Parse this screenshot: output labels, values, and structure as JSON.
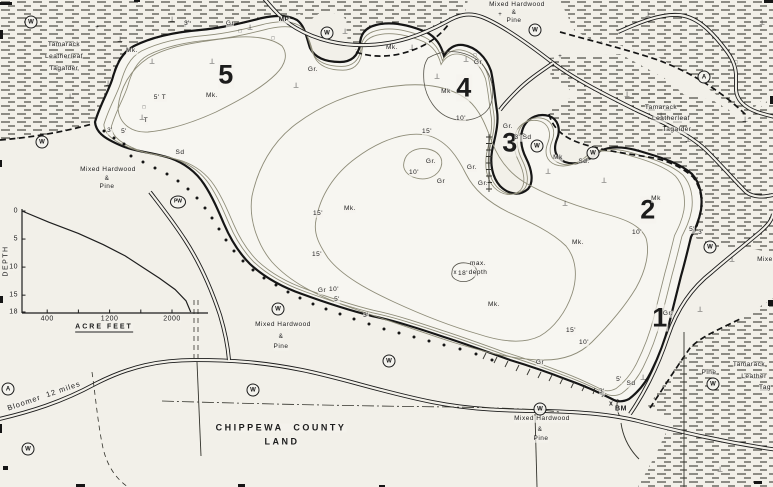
{
  "map": {
    "labels": [
      {
        "n": "veg-label-tamarack-nw-line1",
        "t": "Tamarack",
        "x": 64,
        "y": 45
      },
      {
        "n": "veg-label-tamarack-nw-line2",
        "t": "Leatherleaf",
        "x": 64,
        "y": 57
      },
      {
        "n": "veg-label-tamarack-nw-line3",
        "t": "Tagalder",
        "x": 64,
        "y": 69
      },
      {
        "n": "veg-label-mixed-hardwood-north-line1",
        "t": "Mixed Hardwood",
        "x": 517,
        "y": 5
      },
      {
        "n": "veg-label-mixed-hardwood-north-line2",
        "t": "&",
        "x": 514,
        "y": 13
      },
      {
        "n": "veg-label-mixed-hardwood-north-line3",
        "t": "Pine",
        "x": 514,
        "y": 21
      },
      {
        "n": "veg-label-tamarack-east-line1",
        "t": "Tamarack",
        "x": 661,
        "y": 108
      },
      {
        "n": "veg-label-tamarack-east-line2",
        "t": "Leatherleaf",
        "x": 671,
        "y": 119
      },
      {
        "n": "veg-label-tamarack-east-line3",
        "t": "Tagalder",
        "x": 677,
        "y": 130
      },
      {
        "n": "veg-label-mixed-hardwood-west-line1",
        "t": "Mixed Hardwood",
        "x": 108,
        "y": 170
      },
      {
        "n": "veg-label-mixed-hardwood-west-line2",
        "t": "&",
        "x": 107,
        "y": 179
      },
      {
        "n": "veg-label-mixed-hardwood-west-line3",
        "t": "Pine",
        "x": 107,
        "y": 187
      },
      {
        "n": "veg-label-mixed-hardwood-south-line1",
        "t": "Mixed Hardwood",
        "x": 283,
        "y": 325
      },
      {
        "n": "veg-label-mixed-hardwood-south-line2",
        "t": "&",
        "x": 281,
        "y": 337
      },
      {
        "n": "veg-label-mixed-hardwood-south-line3",
        "t": "Pine",
        "x": 281,
        "y": 347
      },
      {
        "n": "veg-label-mixed-hardwood-southeast-line1",
        "t": "Mixed Hardwood",
        "x": 542,
        "y": 419
      },
      {
        "n": "veg-label-mixed-hardwood-southeast-line2",
        "t": "&",
        "x": 540,
        "y": 430
      },
      {
        "n": "veg-label-mixed-hardwood-southeast-line3",
        "t": "Pine",
        "x": 541,
        "y": 439
      },
      {
        "n": "veg-label-pine-southeast",
        "t": "Pine",
        "x": 709,
        "y": 373
      },
      {
        "n": "veg-label-tamarack-se-line1",
        "t": "Tamarack",
        "x": 749,
        "y": 365
      },
      {
        "n": "veg-label-tamarack-se-line2",
        "t": "Leather",
        "x": 754,
        "y": 377
      },
      {
        "n": "veg-label-tamarack-se-line3",
        "t": "Tag",
        "x": 765,
        "y": 388
      },
      {
        "n": "veg-label-mixed-east-partial",
        "t": "Mixed",
        "x": 767,
        "y": 260
      },
      {
        "n": "county-land-label-line1",
        "t": "CHIPPEWA  COUNTY",
        "x": 281,
        "y": 428,
        "fs": 9,
        "fw": 700,
        "ls": 2.5
      },
      {
        "n": "county-land-label-line2",
        "t": "LAND",
        "x": 282,
        "y": 442,
        "fs": 9,
        "fw": 700,
        "ls": 2.5
      },
      {
        "n": "road-label-bloomer",
        "t": "Bloomer  12 miles",
        "x": 44,
        "y": 396,
        "fs": 7.5,
        "r": -19,
        "ls": 1
      },
      {
        "n": "site-number-5",
        "t": "5",
        "x": 226,
        "y": 75,
        "fs": 27,
        "fw": 800
      },
      {
        "n": "site-number-4",
        "t": "4",
        "x": 464,
        "y": 88,
        "fs": 27,
        "fw": 800
      },
      {
        "n": "site-number-3",
        "t": "3",
        "x": 510,
        "y": 143,
        "fs": 27,
        "fw": 800
      },
      {
        "n": "site-number-2",
        "t": "2",
        "x": 648,
        "y": 210,
        "fs": 27,
        "fw": 800
      },
      {
        "n": "site-number-1",
        "t": "1",
        "x": 660,
        "y": 318,
        "fs": 27,
        "fw": 800
      },
      {
        "n": "marker-mp",
        "t": "MP",
        "x": 284,
        "y": 20,
        "fw": 700
      },
      {
        "n": "marker-bm",
        "t": "BM",
        "x": 621,
        "y": 409,
        "fs": 7,
        "fw": 700
      },
      {
        "n": "substrate-label",
        "t": "Mk.",
        "x": 132,
        "y": 51
      },
      {
        "n": "substrate-label",
        "t": "Mk.",
        "x": 212,
        "y": 96
      },
      {
        "n": "depth-label",
        "t": "5' T",
        "x": 160,
        "y": 98
      },
      {
        "n": "substrate-label",
        "t": "T",
        "x": 146,
        "y": 121
      },
      {
        "n": "depth-label",
        "t": "3'",
        "x": 110,
        "y": 131
      },
      {
        "n": "depth-label",
        "t": "5'",
        "x": 124,
        "y": 132
      },
      {
        "n": "substrate-label",
        "t": "Sd",
        "x": 180,
        "y": 153
      },
      {
        "n": "depth-label",
        "t": "3'",
        "x": 187,
        "y": 24
      },
      {
        "n": "substrate-label",
        "t": "Gr",
        "x": 230,
        "y": 24
      },
      {
        "n": "substrate-label",
        "t": "Gr.",
        "x": 313,
        "y": 70
      },
      {
        "n": "substrate-label",
        "t": "Mk.",
        "x": 392,
        "y": 48
      },
      {
        "n": "substrate-label",
        "t": "Gr",
        "x": 478,
        "y": 63
      },
      {
        "n": "substrate-label",
        "t": "Mk",
        "x": 446,
        "y": 92
      },
      {
        "n": "depth-label",
        "t": "10'",
        "x": 461,
        "y": 119
      },
      {
        "n": "depth-label",
        "t": "15'",
        "x": 427,
        "y": 132
      },
      {
        "n": "substrate-label",
        "t": "Gr.",
        "x": 431,
        "y": 162
      },
      {
        "n": "depth-label",
        "t": "10'",
        "x": 414,
        "y": 173
      },
      {
        "n": "substrate-label",
        "t": "Gr",
        "x": 441,
        "y": 182
      },
      {
        "n": "substrate-label",
        "t": "Gr.",
        "x": 508,
        "y": 127
      },
      {
        "n": "depth-label",
        "t": "3' Sd",
        "x": 523,
        "y": 138
      },
      {
        "n": "substrate-label",
        "t": "Mk",
        "x": 558,
        "y": 158
      },
      {
        "n": "substrate-label",
        "t": "Sd.",
        "x": 584,
        "y": 162
      },
      {
        "n": "substrate-label",
        "t": "Gr.",
        "x": 472,
        "y": 168
      },
      {
        "n": "substrate-label",
        "t": "Gr.",
        "x": 483,
        "y": 184
      },
      {
        "n": "substrate-label",
        "t": "Mk.",
        "x": 350,
        "y": 209
      },
      {
        "n": "depth-label",
        "t": "15'",
        "x": 318,
        "y": 214
      },
      {
        "n": "depth-label",
        "t": "15'",
        "x": 317,
        "y": 255
      },
      {
        "n": "substrate-label",
        "t": "Mk.",
        "x": 578,
        "y": 243
      },
      {
        "n": "substrate-label",
        "t": "Mk",
        "x": 656,
        "y": 199
      },
      {
        "n": "depth-label",
        "t": "10'",
        "x": 637,
        "y": 233
      },
      {
        "n": "depth-label",
        "t": "5'",
        "x": 692,
        "y": 230
      },
      {
        "n": "depth-label",
        "t": "3'",
        "x": 701,
        "y": 233
      },
      {
        "n": "max-depth-label-line1",
        "t": "max.",
        "x": 478,
        "y": 264
      },
      {
        "n": "max-depth-label-line2",
        "t": "depth",
        "x": 478,
        "y": 273
      },
      {
        "n": "max-depth-value",
        "t": "18'",
        "x": 463,
        "y": 274
      },
      {
        "n": "substrate-label",
        "t": "Mk.",
        "x": 494,
        "y": 305
      },
      {
        "n": "substrate-label",
        "t": "Gr",
        "x": 322,
        "y": 291
      },
      {
        "n": "depth-label",
        "t": "10'",
        "x": 334,
        "y": 290
      },
      {
        "n": "depth-label",
        "t": "5'",
        "x": 337,
        "y": 300
      },
      {
        "n": "depth-label",
        "t": "3'",
        "x": 366,
        "y": 316
      },
      {
        "n": "depth-label",
        "t": "15'",
        "x": 571,
        "y": 331
      },
      {
        "n": "depth-label",
        "t": "10'",
        "x": 584,
        "y": 343
      },
      {
        "n": "substrate-label",
        "t": "Gr",
        "x": 540,
        "y": 363
      },
      {
        "n": "depth-label",
        "t": "3'",
        "x": 602,
        "y": 392
      },
      {
        "n": "depth-label",
        "t": "5'",
        "x": 619,
        "y": 380
      },
      {
        "n": "substrate-label",
        "t": "Sd",
        "x": 631,
        "y": 384
      },
      {
        "n": "substrate-label",
        "t": "Gr.",
        "x": 668,
        "y": 314
      }
    ],
    "circled_symbols": [
      {
        "t": "W",
        "x": 31,
        "y": 22
      },
      {
        "t": "W",
        "x": 42,
        "y": 142
      },
      {
        "t": "W",
        "x": 327,
        "y": 33
      },
      {
        "t": "W",
        "x": 535,
        "y": 30
      },
      {
        "t": "A",
        "x": 704,
        "y": 77
      },
      {
        "t": "W",
        "x": 537,
        "y": 146
      },
      {
        "t": "W",
        "x": 593,
        "y": 153
      },
      {
        "t": "W",
        "x": 710,
        "y": 247
      },
      {
        "t": "PW",
        "x": 178,
        "y": 202
      },
      {
        "t": "W",
        "x": 278,
        "y": 309
      },
      {
        "t": "W",
        "x": 253,
        "y": 390
      },
      {
        "t": "W",
        "x": 389,
        "y": 361
      },
      {
        "t": "W",
        "x": 540,
        "y": 409
      },
      {
        "t": "W",
        "x": 713,
        "y": 384
      },
      {
        "t": "A",
        "x": 8,
        "y": 389
      },
      {
        "t": "W",
        "x": 28,
        "y": 449
      }
    ],
    "point_symbols": [
      {
        "n": "snag-symbol",
        "t": "⊥",
        "x": 120,
        "y": 40
      },
      {
        "n": "snag-symbol",
        "t": "⊥",
        "x": 152,
        "y": 62
      },
      {
        "n": "snag-symbol",
        "t": "⊥",
        "x": 172,
        "y": 20
      },
      {
        "n": "snag-symbol",
        "t": "⊥",
        "x": 212,
        "y": 62
      },
      {
        "n": "snag-symbol",
        "t": "⊥",
        "x": 250,
        "y": 28
      },
      {
        "n": "snag-symbol",
        "t": "⊥",
        "x": 108,
        "y": 84
      },
      {
        "n": "snag-symbol",
        "t": "⊥",
        "x": 70,
        "y": 97
      },
      {
        "n": "snag-symbol",
        "t": "⊥",
        "x": 142,
        "y": 118
      },
      {
        "n": "snag-symbol",
        "t": "⊥",
        "x": 296,
        "y": 86
      },
      {
        "n": "snag-symbol",
        "t": "⊥",
        "x": 345,
        "y": 32
      },
      {
        "n": "snag-symbol",
        "t": "⊥",
        "x": 412,
        "y": 48
      },
      {
        "n": "snag-symbol",
        "t": "⊥",
        "x": 437,
        "y": 77
      },
      {
        "n": "snag-symbol",
        "t": "⊥",
        "x": 466,
        "y": 60
      },
      {
        "n": "snag-symbol",
        "t": "⊥",
        "x": 522,
        "y": 132
      },
      {
        "n": "snag-symbol",
        "t": "⊥",
        "x": 548,
        "y": 172
      },
      {
        "n": "snag-symbol",
        "t": "⊥",
        "x": 604,
        "y": 181
      },
      {
        "n": "snag-symbol",
        "t": "⊥",
        "x": 627,
        "y": 95
      },
      {
        "n": "snag-symbol",
        "t": "⊥",
        "x": 661,
        "y": 116
      },
      {
        "n": "snag-symbol",
        "t": "⊥",
        "x": 688,
        "y": 140
      },
      {
        "n": "snag-symbol",
        "t": "⊥",
        "x": 565,
        "y": 204
      },
      {
        "n": "snag-symbol",
        "t": "⊥",
        "x": 745,
        "y": 120
      },
      {
        "n": "snag-symbol",
        "t": "⊥",
        "x": 762,
        "y": 23
      },
      {
        "n": "snag-symbol",
        "t": "⊥",
        "x": 648,
        "y": 15
      },
      {
        "n": "snag-symbol",
        "t": "⊥",
        "x": 643,
        "y": 378
      },
      {
        "n": "snag-symbol",
        "t": "⊥",
        "x": 720,
        "y": 470
      },
      {
        "n": "snag-symbol",
        "t": "⊥",
        "x": 700,
        "y": 310
      },
      {
        "n": "snag-symbol",
        "t": "⊥",
        "x": 732,
        "y": 260
      },
      {
        "n": "structure-symbol",
        "t": "□",
        "x": 240,
        "y": 32,
        "fs": 5
      },
      {
        "n": "structure-symbol",
        "t": "□",
        "x": 273,
        "y": 39,
        "fs": 5
      },
      {
        "n": "structure-symbol",
        "t": "□",
        "x": 144,
        "y": 108,
        "fs": 5
      },
      {
        "n": "structure-symbol",
        "t": "□",
        "x": 475,
        "y": 56,
        "fs": 5
      },
      {
        "n": "structure-symbol",
        "t": "□",
        "x": 736,
        "y": 63,
        "fs": 5
      },
      {
        "n": "cross-symbol",
        "t": "+",
        "x": 500,
        "y": 15,
        "fs": 6
      },
      {
        "n": "cross-symbol",
        "t": "+",
        "x": 560,
        "y": 57,
        "fs": 6
      },
      {
        "n": "cross-symbol",
        "t": "+",
        "x": 97,
        "y": 28,
        "fs": 6
      },
      {
        "n": "max-depth-x-marker",
        "t": "x",
        "x": 455,
        "y": 273,
        "fs": 6
      },
      {
        "n": "benchmark-x-marker",
        "t": "x",
        "x": 611,
        "y": 404,
        "fs": 7,
        "fw": 700
      }
    ],
    "shore_dots": [
      [
        131,
        156
      ],
      [
        143,
        162
      ],
      [
        155,
        168
      ],
      [
        167,
        174
      ],
      [
        178,
        181
      ],
      [
        188,
        189
      ],
      [
        197,
        198
      ],
      [
        205,
        208
      ],
      [
        212,
        218
      ],
      [
        219,
        229
      ],
      [
        226,
        240
      ],
      [
        234,
        251
      ],
      [
        243,
        261
      ],
      [
        253,
        270
      ],
      [
        264,
        278
      ],
      [
        276,
        285
      ],
      [
        288,
        292
      ],
      [
        300,
        298
      ],
      [
        313,
        304
      ],
      [
        326,
        309
      ],
      [
        340,
        314
      ],
      [
        354,
        319
      ],
      [
        369,
        324
      ],
      [
        384,
        329
      ],
      [
        399,
        333
      ],
      [
        414,
        337
      ],
      [
        429,
        341
      ],
      [
        444,
        345
      ],
      [
        460,
        349
      ],
      [
        476,
        354
      ],
      [
        492,
        360
      ],
      [
        104,
        131
      ],
      [
        114,
        138
      ],
      [
        124,
        144
      ]
    ]
  },
  "chart_data": {
    "type": "line",
    "title": "",
    "xlabel": "ACRE FEET",
    "ylabel": "DEPTH",
    "x_ticks_all": [
      400,
      800,
      1200,
      1600,
      2000
    ],
    "x_tick_labels": [
      400,
      1200,
      2000
    ],
    "y_ticks": [
      0,
      5,
      10,
      15,
      18
    ],
    "x_range": [
      0,
      2300
    ],
    "y_range": [
      0,
      18
    ],
    "x_unit": "acre-feet",
    "y_unit": "feet",
    "series": [
      {
        "name": "depth-volume curve",
        "points": [
          [
            0,
            0
          ],
          [
            420,
            2
          ],
          [
            800,
            4
          ],
          [
            1120,
            6
          ],
          [
            1400,
            8
          ],
          [
            1620,
            10
          ],
          [
            1840,
            12
          ],
          [
            2040,
            14
          ],
          [
            2180,
            16
          ],
          [
            2240,
            18
          ]
        ]
      }
    ],
    "annotations": [
      "max. depth 18'"
    ],
    "legend": false,
    "grid": false
  }
}
